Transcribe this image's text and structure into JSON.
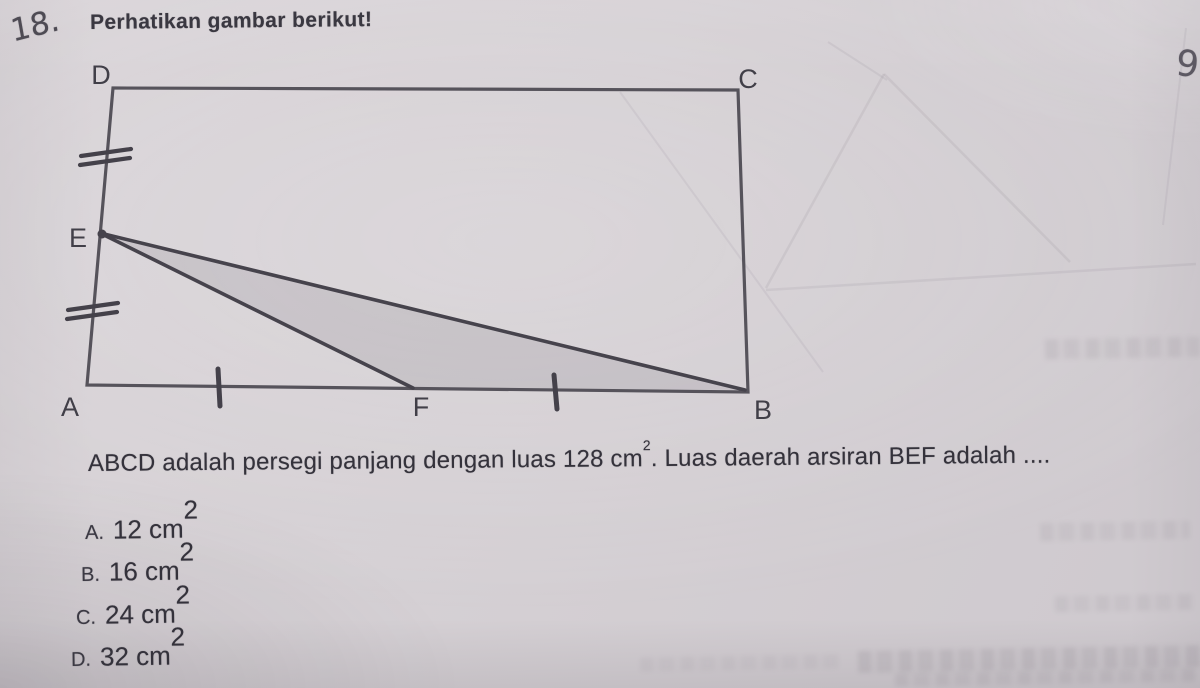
{
  "header": {
    "question_number": "18.",
    "prompt": "Perhatikan gambar berikut!",
    "margin_note": "9"
  },
  "figure": {
    "type": "geometry-diagram",
    "description": "Rectangle ABCD; E is midpoint of side AD (double tick marks), F is midpoint of side AB (single tick marks); triangle BEF is shaded",
    "vertex_labels": {
      "top_left": "D",
      "top_right": "C",
      "bottom_right": "B",
      "bottom_left": "A",
      "left_midpoint": "E",
      "bottom_midpoint": "F"
    },
    "shaded_region": "BEF",
    "ink_color": "#46434c",
    "shade_color": "rgba(118,111,122,0.17)"
  },
  "question": {
    "text_before_sup": "ABCD adalah persegi panjang dengan luas 128 cm",
    "sup": "2",
    "text_after_sup": ". Luas daerah arsiran BEF adalah ...."
  },
  "options": [
    {
      "letter": "A.",
      "value": "12 cm",
      "sup": "2"
    },
    {
      "letter": "B.",
      "value": "16 cm",
      "sup": "2"
    },
    {
      "letter": "C.",
      "value": "24 cm",
      "sup": "2"
    },
    {
      "letter": "D.",
      "value": "32 cm",
      "sup": "2"
    }
  ],
  "colors": {
    "paper": "#d5d0d4",
    "ink": "#34323b"
  }
}
